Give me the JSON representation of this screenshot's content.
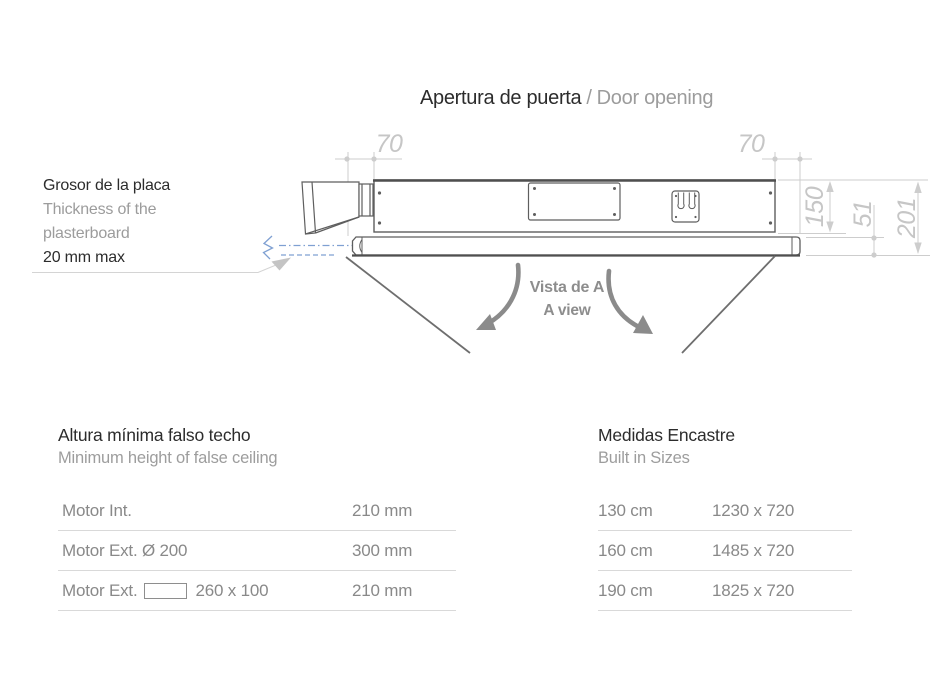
{
  "title": {
    "es": "Apertura de puerta",
    "separator": "/",
    "en": "Door opening"
  },
  "plasterboard_note": {
    "title_es": "Grosor de la placa",
    "subtitle_en_line1": "Thickness of the",
    "subtitle_en_line2": "plasterboard",
    "max_value": "20 mm max"
  },
  "view_label": {
    "es": "Vista de A",
    "en": "A view"
  },
  "drawing": {
    "dim_left_offset": "70",
    "dim_right_offset": "70",
    "dim_housing_height": "150",
    "dim_frame_thickness": "51",
    "dim_total_height": "201",
    "colors": {
      "dimension": "#c6c6c6",
      "outline": "#5e5e5e",
      "hand_arrow": "#8b8b8b",
      "plasterboard_line": "#7fa0d2"
    }
  },
  "left_table": {
    "title_es": "Altura mínima falso techo",
    "title_en": "Minimum height of false ceiling",
    "rows": [
      {
        "pre": "Motor Int.",
        "post": "",
        "value": "210 mm"
      },
      {
        "pre": "Motor Ext. Ø 200",
        "post": "",
        "value": "300 mm"
      },
      {
        "pre": "Motor Ext.",
        "post": "260 x 100",
        "value": "210 mm"
      }
    ]
  },
  "right_table": {
    "title_es": "Medidas Encastre",
    "title_en": "Built in Sizes",
    "rows": [
      {
        "size": "130 cm",
        "dims": "1230 x 720"
      },
      {
        "size": "160 cm",
        "dims": "1485 x 720"
      },
      {
        "size": "190 cm",
        "dims": "1825 x 720"
      }
    ]
  }
}
